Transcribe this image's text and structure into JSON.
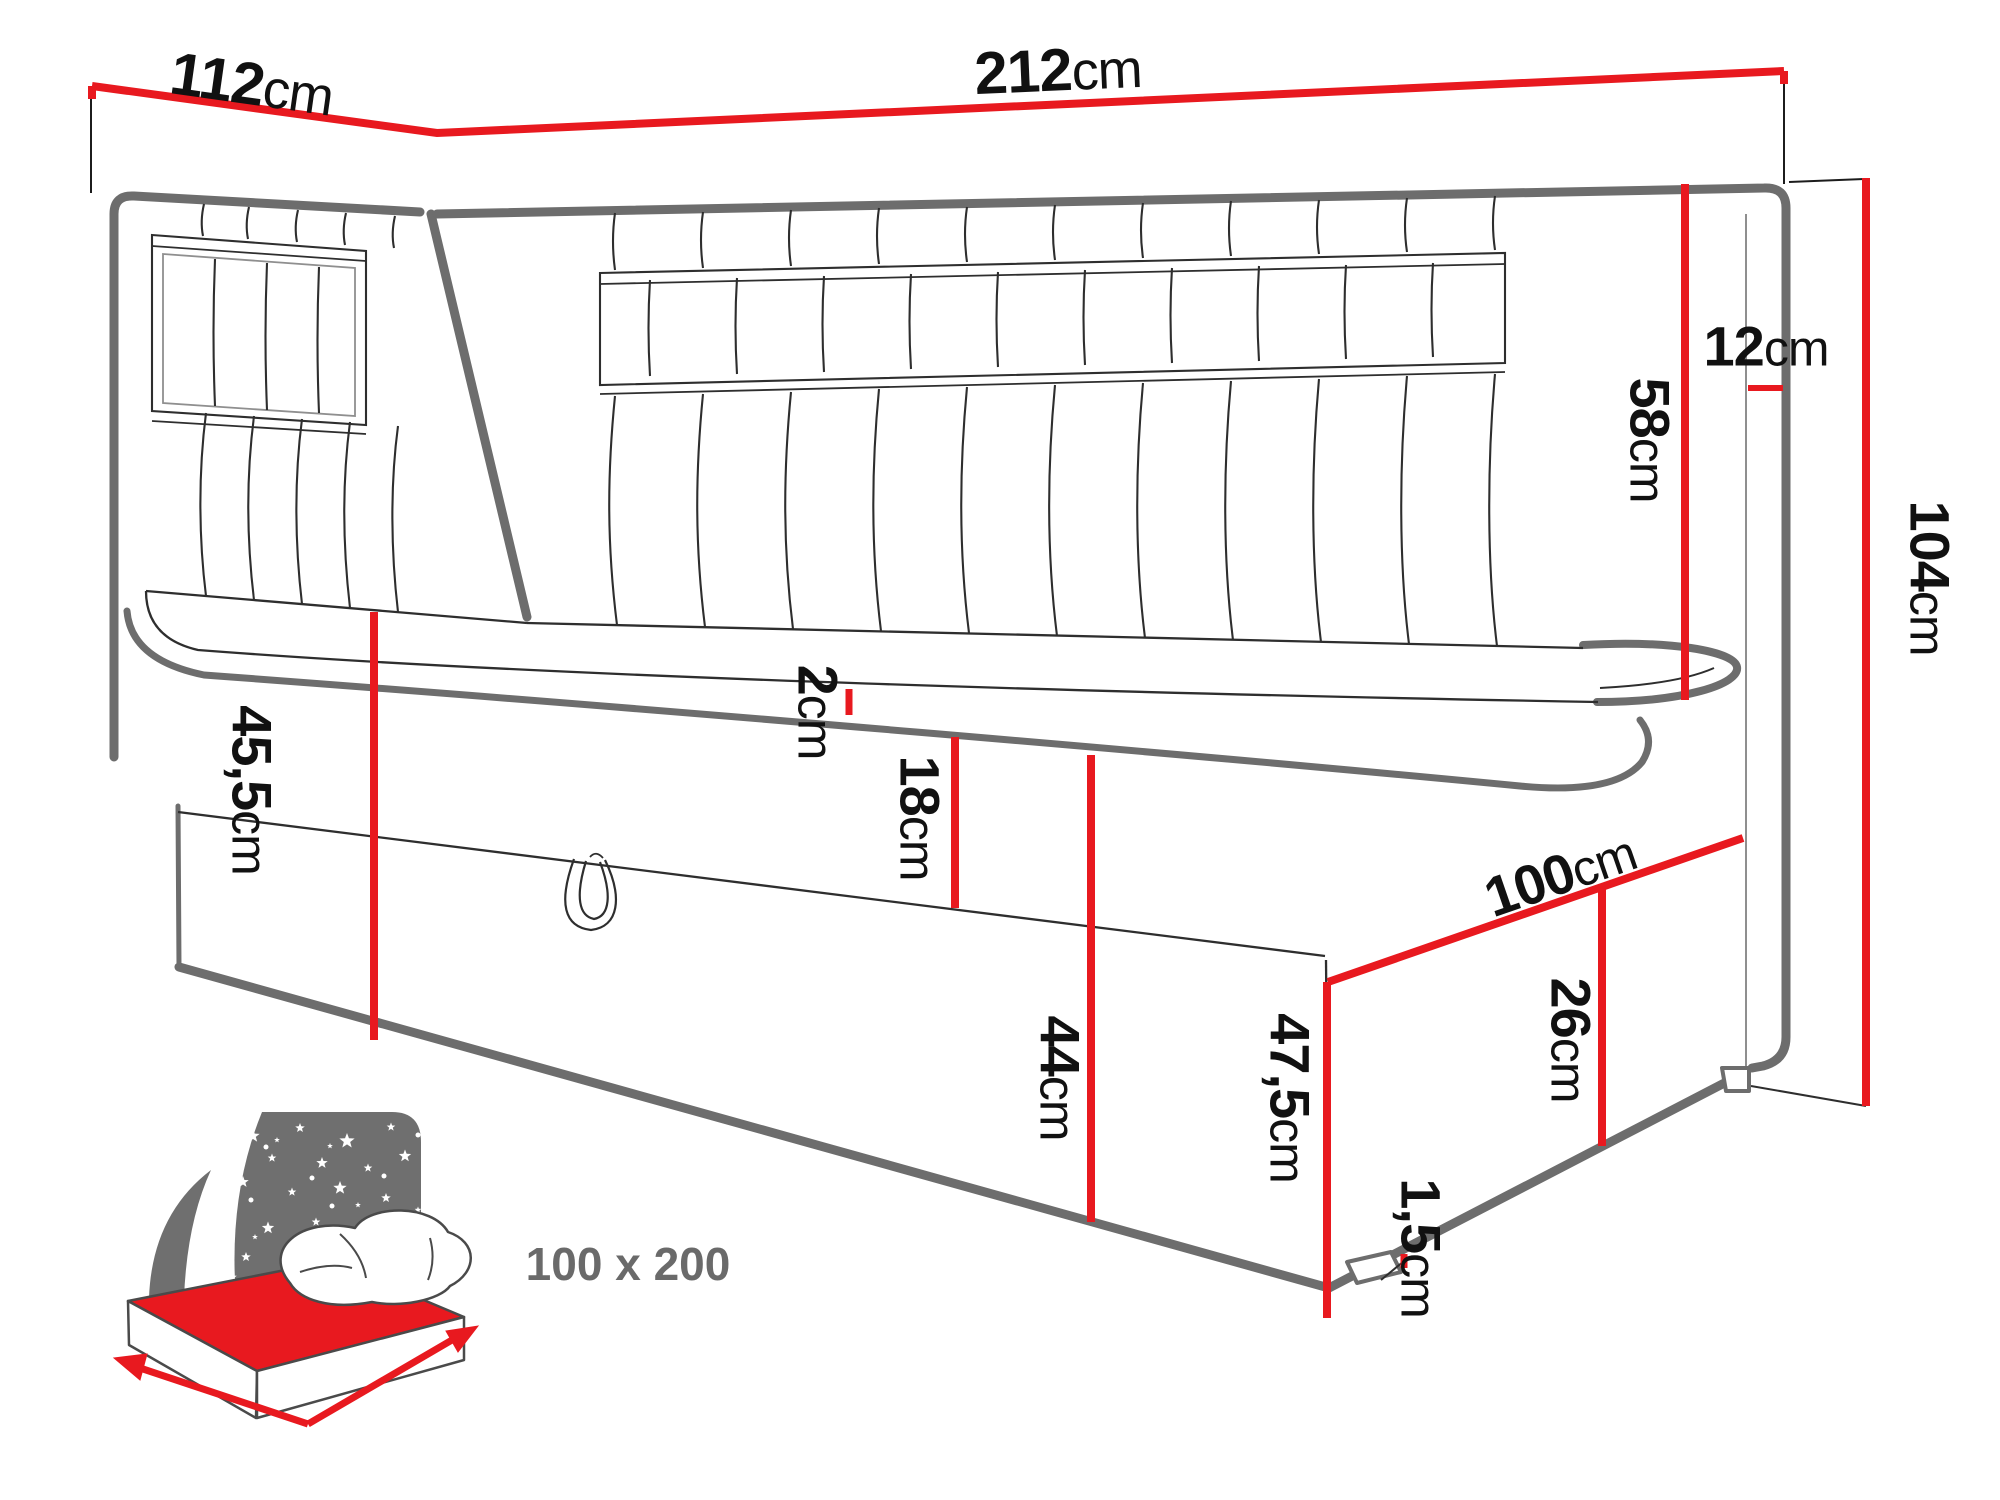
{
  "dimensions": {
    "width_head": {
      "value": "112",
      "unit": "cm"
    },
    "width_long": {
      "value": "212",
      "unit": "cm"
    },
    "headboard_thickness": {
      "value": "12",
      "unit": "cm"
    },
    "headboard_above_mattress": {
      "value": "58",
      "unit": "cm"
    },
    "total_height": {
      "value": "104",
      "unit": "cm"
    },
    "topper_height": {
      "value": "2",
      "unit": "cm"
    },
    "mattress_height": {
      "value": "18",
      "unit": "cm"
    },
    "base_height_left": {
      "value": "45,5",
      "unit": "cm"
    },
    "base_height": {
      "value": "44",
      "unit": "cm"
    },
    "front_corner_height": {
      "value": "47,5",
      "unit": "cm"
    },
    "front_width": {
      "value": "100",
      "unit": "cm"
    },
    "drawer_section_height": {
      "value": "26",
      "unit": "cm"
    },
    "foot_height": {
      "value": "1,5",
      "unit": "cm"
    }
  },
  "icon_caption": {
    "size_label": "100 x 200"
  },
  "colors": {
    "dimension_red": "#e8191f",
    "outline_gray": "#6d6d6d",
    "thin_line": "#2e2e2e",
    "icon_gray": "#6f6f6f",
    "caption_gray": "#6a6a6a",
    "label_black": "#111111"
  }
}
